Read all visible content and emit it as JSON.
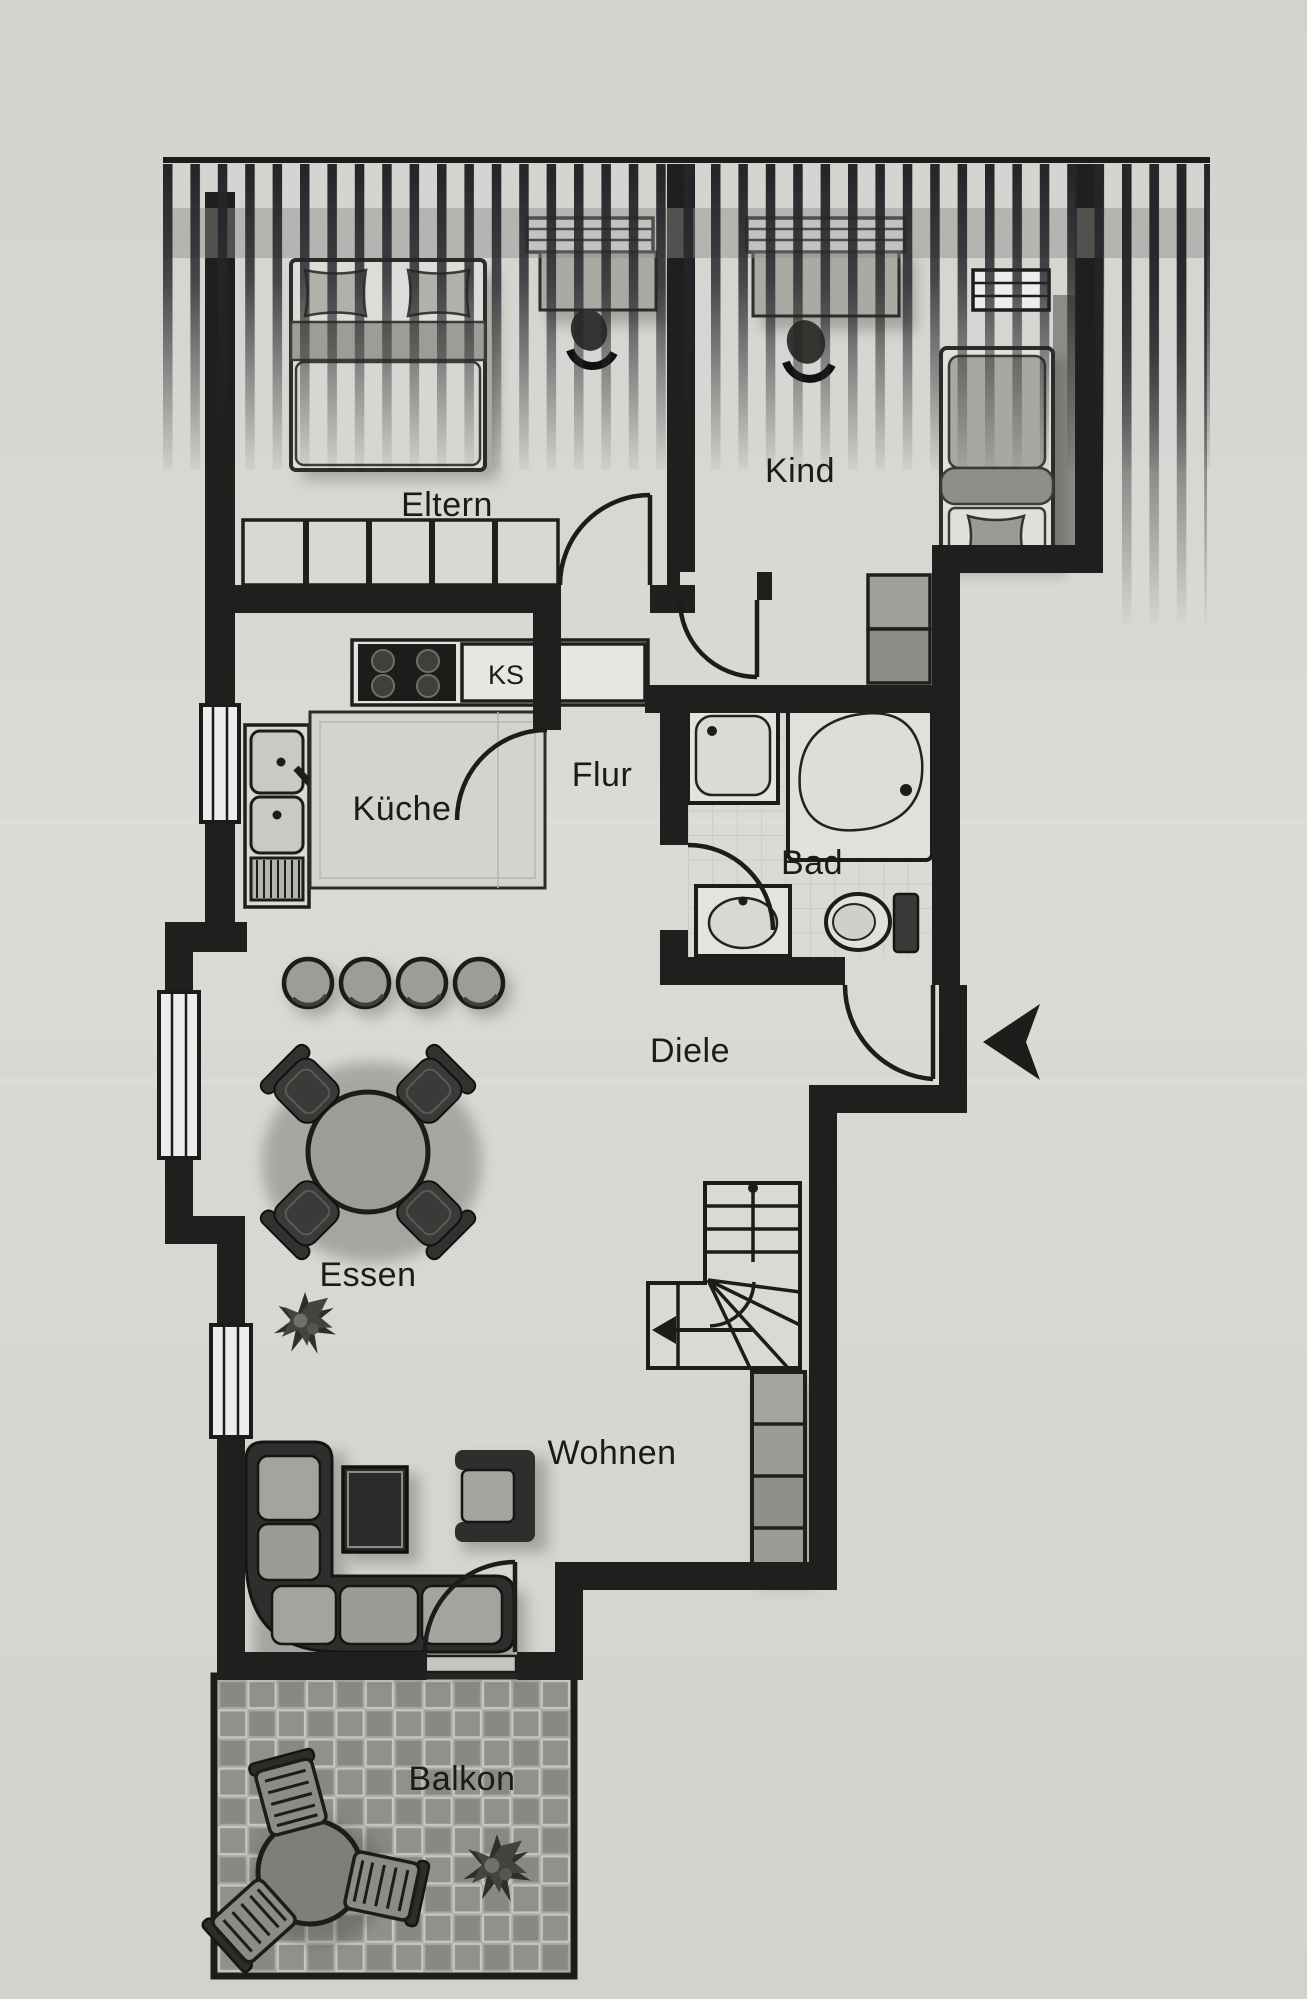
{
  "floor_plan": {
    "title": "apartment-floor-plan",
    "rooms": {
      "eltern": "Eltern",
      "kind": "Kind",
      "kueche": "Küche",
      "flur": "Flur",
      "bad": "Bad",
      "diele": "Diele",
      "essen": "Essen",
      "wohnen": "Wohnen",
      "balkon": "Balkon",
      "kuehlschrank": "KS"
    },
    "symbols": {
      "entrance_arrow": "apartment-entrance",
      "stairs_arrow": "stairs-down-direction",
      "roof_hatch": "roof-slope-hatching"
    },
    "colors": {
      "paper": "#d6d7d2",
      "wall": "#1f1f1d",
      "furniture_light": "#e2e3df",
      "furniture_mid": "#9c9d97",
      "furniture_dark": "#2e2e2c",
      "tile_gray": "#90918b"
    }
  }
}
